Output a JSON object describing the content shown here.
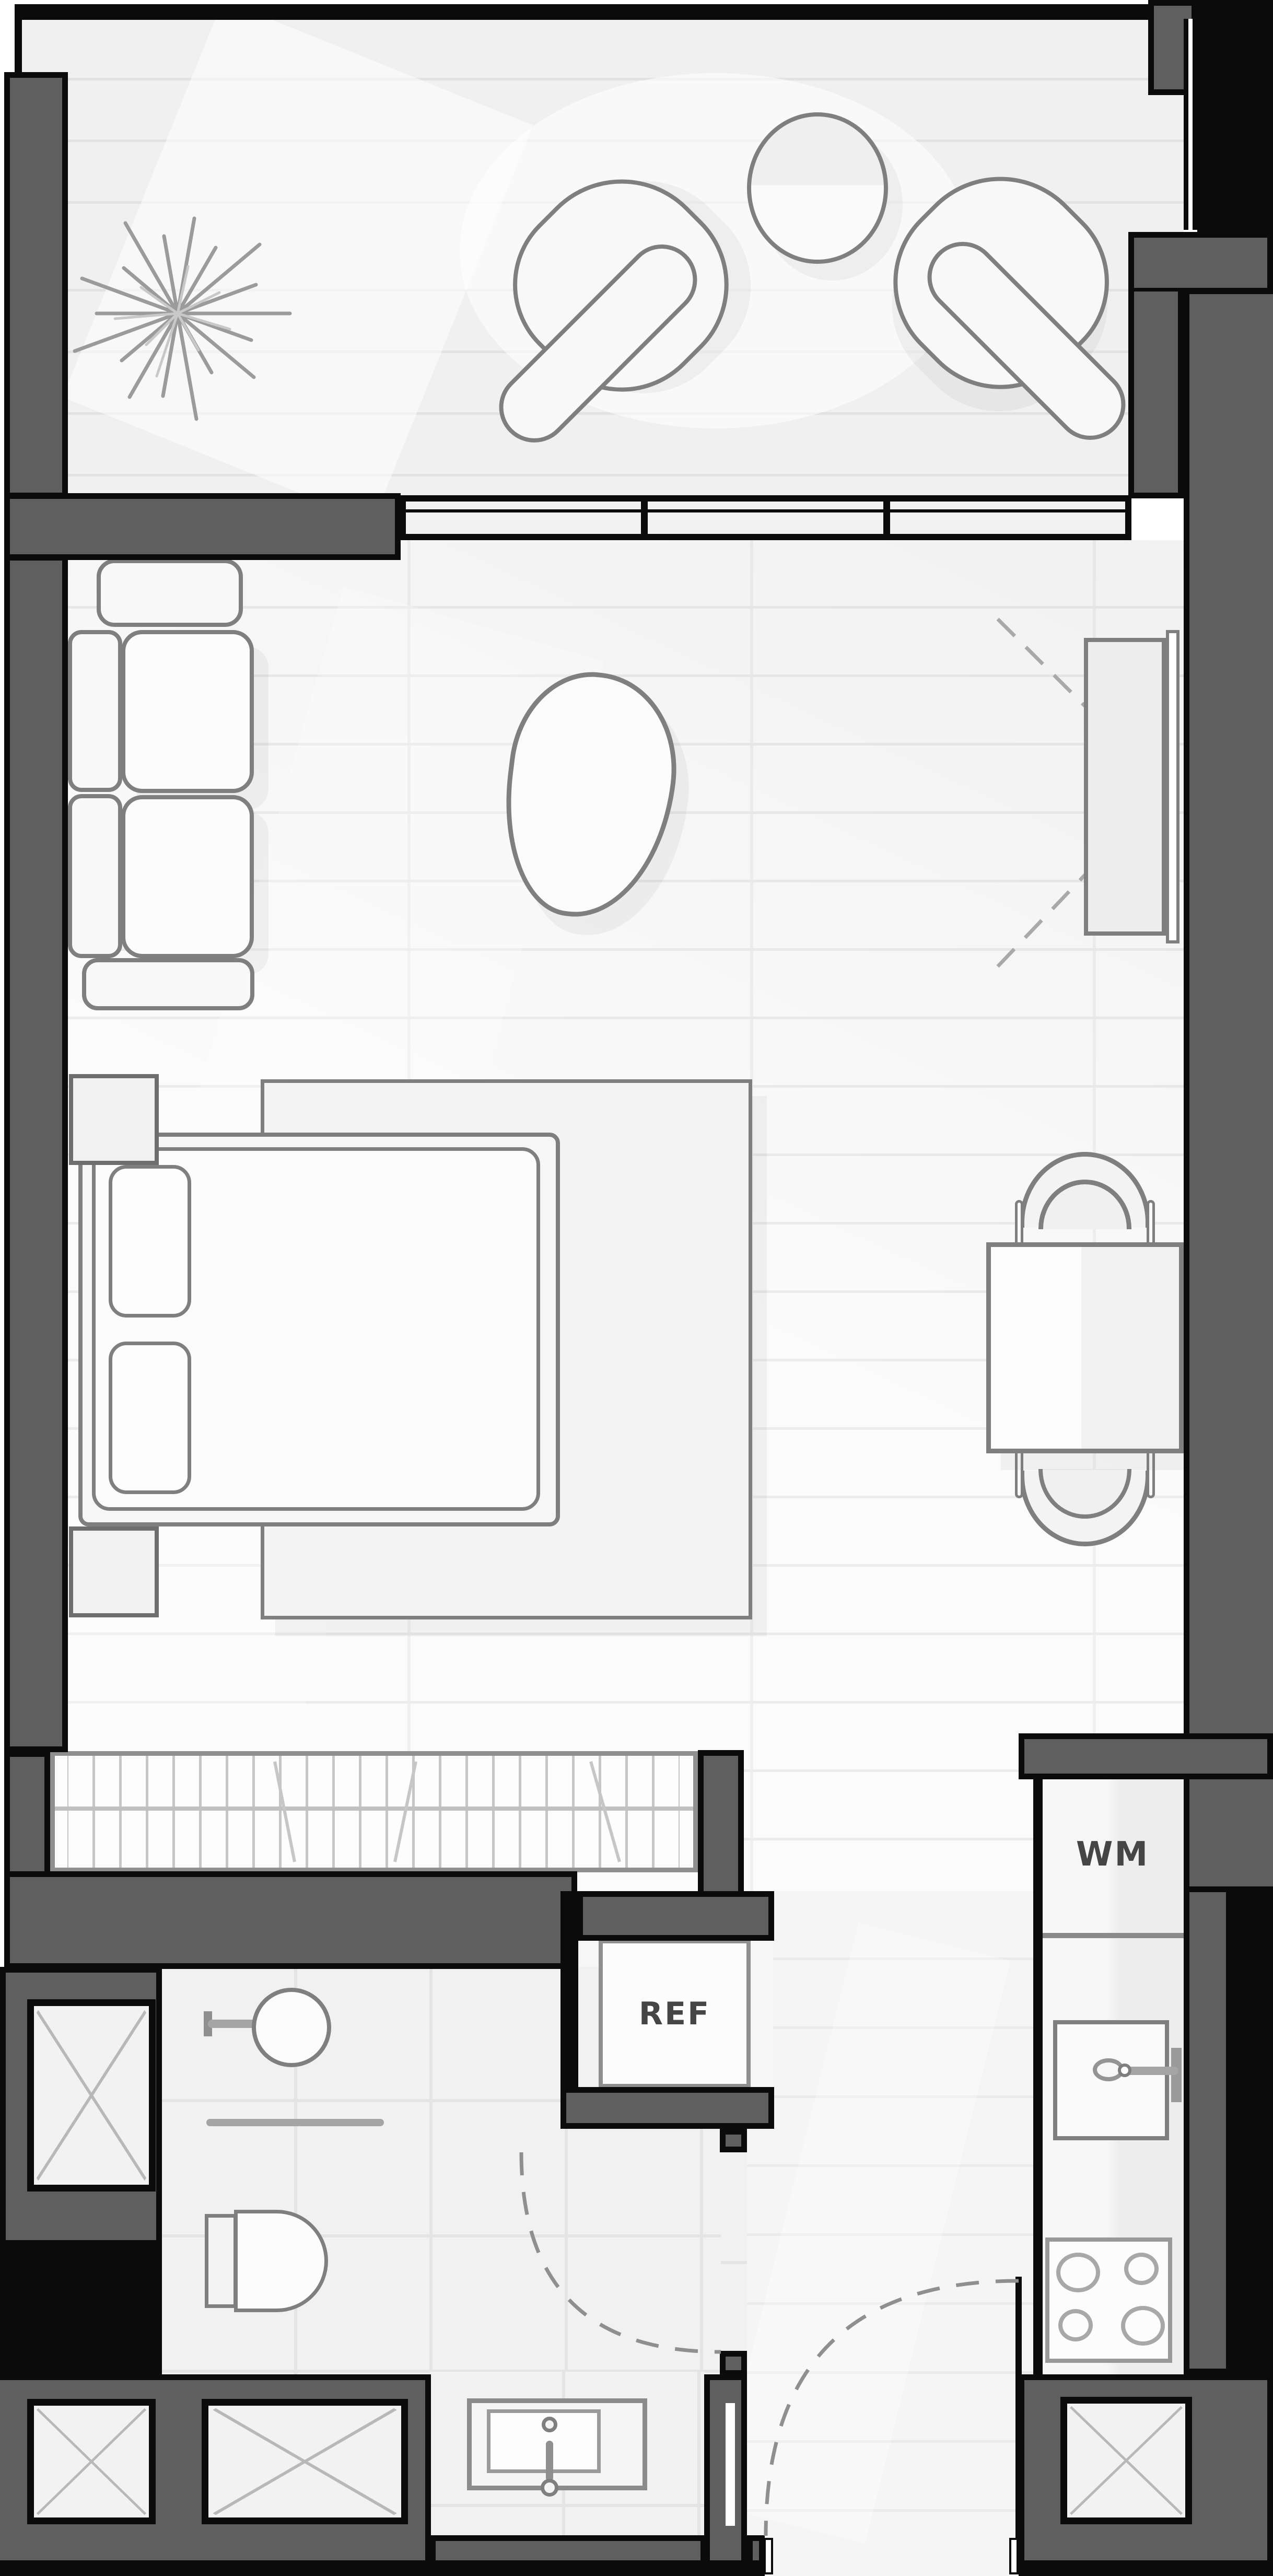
{
  "plan": {
    "type": "studio-apartment-floor-plan"
  },
  "labels": {
    "refrigerator": "REF",
    "washing_machine": "WM"
  },
  "theme": {
    "colors": {
      "wall": "#5f5f5f",
      "outline": "#0b0b0b",
      "stroke": "#7f7f7f",
      "fill": "#f8f8f8",
      "mainfloor": "#fbfbfb",
      "balconyfloor": "#f0f0f0",
      "tilefloor": "#f1f1f1",
      "floorline": "#e2e2e2",
      "labelcolor": "#454545",
      "dash": "#9c9c9c",
      "hanger": "#c6c6c6"
    }
  }
}
